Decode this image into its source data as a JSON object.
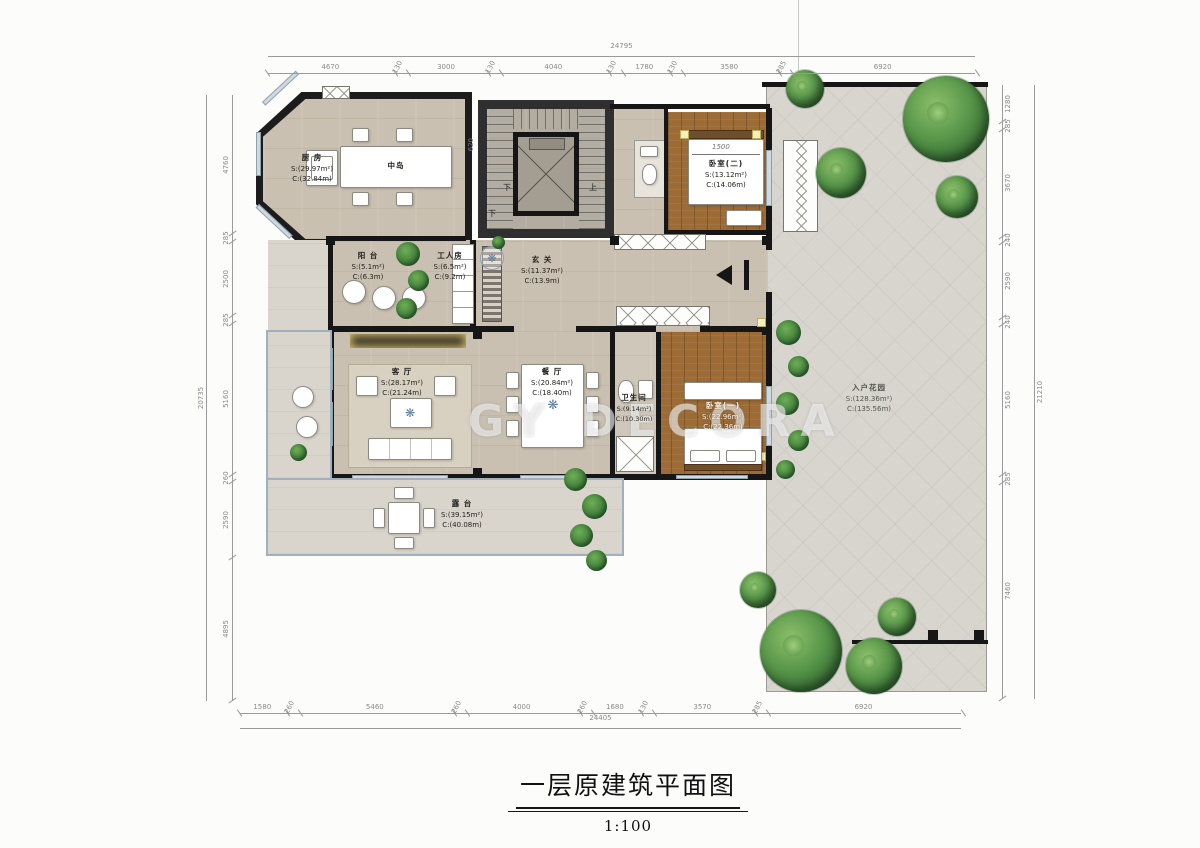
{
  "title": {
    "main": "一层原建筑平面图",
    "scale": "1:100"
  },
  "watermark": {
    "text": "GY DECORA"
  },
  "icons": {
    "medallion": "❋"
  },
  "dims": {
    "top_total": "24795",
    "top": [
      "4670",
      "130",
      "3000",
      "130",
      "4040",
      "130",
      "1780",
      "130",
      "3580",
      "285",
      "6920"
    ],
    "bottom": [
      "1580",
      "260",
      "5460",
      "260",
      "4000",
      "260",
      "1680",
      "130",
      "3570",
      "285",
      "6920"
    ],
    "bottom_total": "24405",
    "left_total": "20735",
    "left": [
      "4760",
      "285",
      "2500",
      "285",
      "5160",
      "260",
      "2590",
      "4895"
    ],
    "right": [
      "1280",
      "285",
      "3670",
      "240",
      "2590",
      "240",
      "5160",
      "285",
      "7460"
    ],
    "right_total": "21210",
    "stair_left": "620",
    "stair_right": "780",
    "bed_width": "1500",
    "stair_down": "下",
    "stair_up": "上",
    "stair_down2": "下"
  },
  "rooms": {
    "kitchen": {
      "name": "厨 房",
      "s": "S:(29.97m²)",
      "c": "C:(32.84m)"
    },
    "island": {
      "name": "中岛"
    },
    "foyer": {
      "name": "玄 关",
      "s": "S:(11.37m²)",
      "c": "C:(13.9m)"
    },
    "maid": {
      "name": "工人房",
      "s": "S:(6.5m²)",
      "c": "C:(9.2m)"
    },
    "balcony": {
      "name": "阳 台",
      "s": "S:(5.1m²)",
      "c": "C:(6.3m)"
    },
    "living": {
      "name": "客 厅",
      "s": "S:(28.17m²)",
      "c": "C:(21.24m)"
    },
    "dining": {
      "name": "餐 厅",
      "s": "S:(20.84m²)",
      "c": "C:(18.40m)"
    },
    "bath": {
      "name": "卫生间",
      "s": "S:(9.14m²)",
      "c": "C:(10.30m)"
    },
    "bed1": {
      "name": "卧室(一)",
      "s": "S:(22.96m²)",
      "c": "C:(22.36m)"
    },
    "bed2": {
      "name": "卧室(二)",
      "s": "S:(13.12m²)",
      "c": "C:(14.06m)"
    },
    "terrace": {
      "name": "露 台",
      "s": "S:(39.15m²)",
      "c": "C:(40.08m)"
    },
    "garden": {
      "name": "入户花园",
      "s": "S:(128.36m²)",
      "c": "C:(135.56m)"
    }
  },
  "colors": {
    "floor_beige": "#c9c0b1",
    "floor_wood": "#9c6b36",
    "paving": "#d8d5cf",
    "wall": "#161616",
    "window": "#cfd9e0",
    "terrace_frame": "#9fb0c0",
    "tree_green": "#4e8f3f",
    "corner_yellow": "#f5efbe"
  }
}
